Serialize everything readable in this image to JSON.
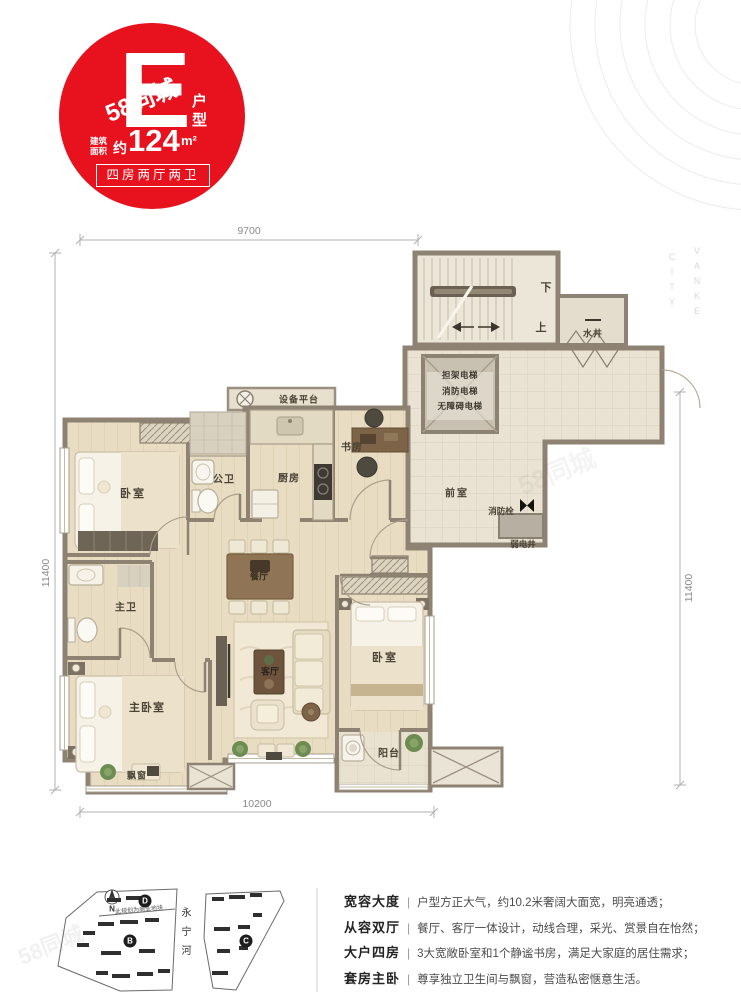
{
  "badge": {
    "type_letter": "E",
    "type_suffix": "户型",
    "area_prefix_l1": "建筑",
    "area_prefix_l2": "面积",
    "area_approx": "约",
    "area_value": "124",
    "area_unit": "m²",
    "layout_text": "四房两厅两卫",
    "color": "#e8121f"
  },
  "dimensions": {
    "top": "9700",
    "bottom": "10200",
    "left": "11400",
    "right": "11400"
  },
  "floorplan": {
    "wall_color": "#8e8273",
    "floor_color": "#e8ddc2",
    "labels": [
      {
        "name": "equipment-platform",
        "text": "设备平台",
        "x": 299,
        "y": 399,
        "fs": 9,
        "ls": 1
      },
      {
        "name": "bedroom-1",
        "text": "卧室",
        "x": 133,
        "y": 493,
        "fs": 11,
        "ls": 2
      },
      {
        "name": "guest-bath",
        "text": "公卫",
        "x": 224,
        "y": 478,
        "fs": 10,
        "ls": 1
      },
      {
        "name": "kitchen",
        "text": "厨房",
        "x": 289,
        "y": 477,
        "fs": 10,
        "ls": 1
      },
      {
        "name": "study",
        "text": "书房",
        "x": 352,
        "y": 446,
        "fs": 10,
        "ls": 1
      },
      {
        "name": "front-room",
        "text": "前室",
        "x": 457,
        "y": 492,
        "fs": 10,
        "ls": 2
      },
      {
        "name": "fire-hydrant",
        "text": "消防栓",
        "x": 501,
        "y": 511,
        "fs": 8.5,
        "ls": 0
      },
      {
        "name": "weak-elec-shaft",
        "text": "弱电井",
        "x": 523,
        "y": 544,
        "fs": 8.5,
        "ls": 0
      },
      {
        "name": "water-well",
        "text": "水井",
        "x": 593,
        "y": 333,
        "fs": 9,
        "ls": 1
      },
      {
        "name": "stair-down",
        "text": "下",
        "x": 546,
        "y": 287,
        "fs": 11,
        "ls": 0
      },
      {
        "name": "stair-up",
        "text": "上",
        "x": 541,
        "y": 327,
        "fs": 11,
        "ls": 0
      },
      {
        "name": "dining",
        "text": "餐厅",
        "x": 259,
        "y": 576,
        "fs": 9,
        "ls": 0,
        "color": "#3a2f23"
      },
      {
        "name": "master-bath",
        "text": "主卫",
        "x": 126,
        "y": 606,
        "fs": 10,
        "ls": 1
      },
      {
        "name": "living",
        "text": "客厅",
        "x": 270,
        "y": 671,
        "fs": 9,
        "ls": 0,
        "color": "#2c261f"
      },
      {
        "name": "master-bedroom",
        "text": "主卧室",
        "x": 147,
        "y": 707,
        "fs": 11,
        "ls": 1
      },
      {
        "name": "bedroom-2",
        "text": "卧室",
        "x": 385,
        "y": 657,
        "fs": 11,
        "ls": 2
      },
      {
        "name": "balcony",
        "text": "阳台",
        "x": 389,
        "y": 752,
        "fs": 10,
        "ls": 1
      },
      {
        "name": "bay-window",
        "text": "飘窗",
        "x": 137,
        "y": 775,
        "fs": 9,
        "ls": 1
      }
    ],
    "elevator_lines": [
      "担架电梯",
      "消防电梯",
      "无障碍电梯"
    ]
  },
  "sitemap": {
    "north": "N",
    "river": "永宁河",
    "note": "此规划为商业地块",
    "parcels": [
      {
        "letter": "D",
        "x": 145,
        "y": 901
      },
      {
        "letter": "B",
        "x": 130,
        "y": 941
      },
      {
        "letter": "C",
        "x": 246,
        "y": 941
      }
    ]
  },
  "features": [
    {
      "title": "宽容大度",
      "sep": "|",
      "desc": "户型方正大气，约10.2米奢阔大面宽，明亮通透；"
    },
    {
      "title": "从容双厅",
      "sep": "|",
      "desc": "餐厅、客厅一体设计，动线合理，采光、赏景自在怡然；"
    },
    {
      "title": "大户四房",
      "sep": "|",
      "desc": "3大宽敞卧室和1个静谧书房，满足大家庭的居住需求；"
    },
    {
      "title": "套房主卧",
      "sep": "|",
      "desc": "尊享独立卫生间与飘窗，营造私密惬意生活。"
    }
  ],
  "watermarks": {
    "site": "58同城",
    "brand_line1": "VANKE",
    "brand_line2": "CITY"
  }
}
